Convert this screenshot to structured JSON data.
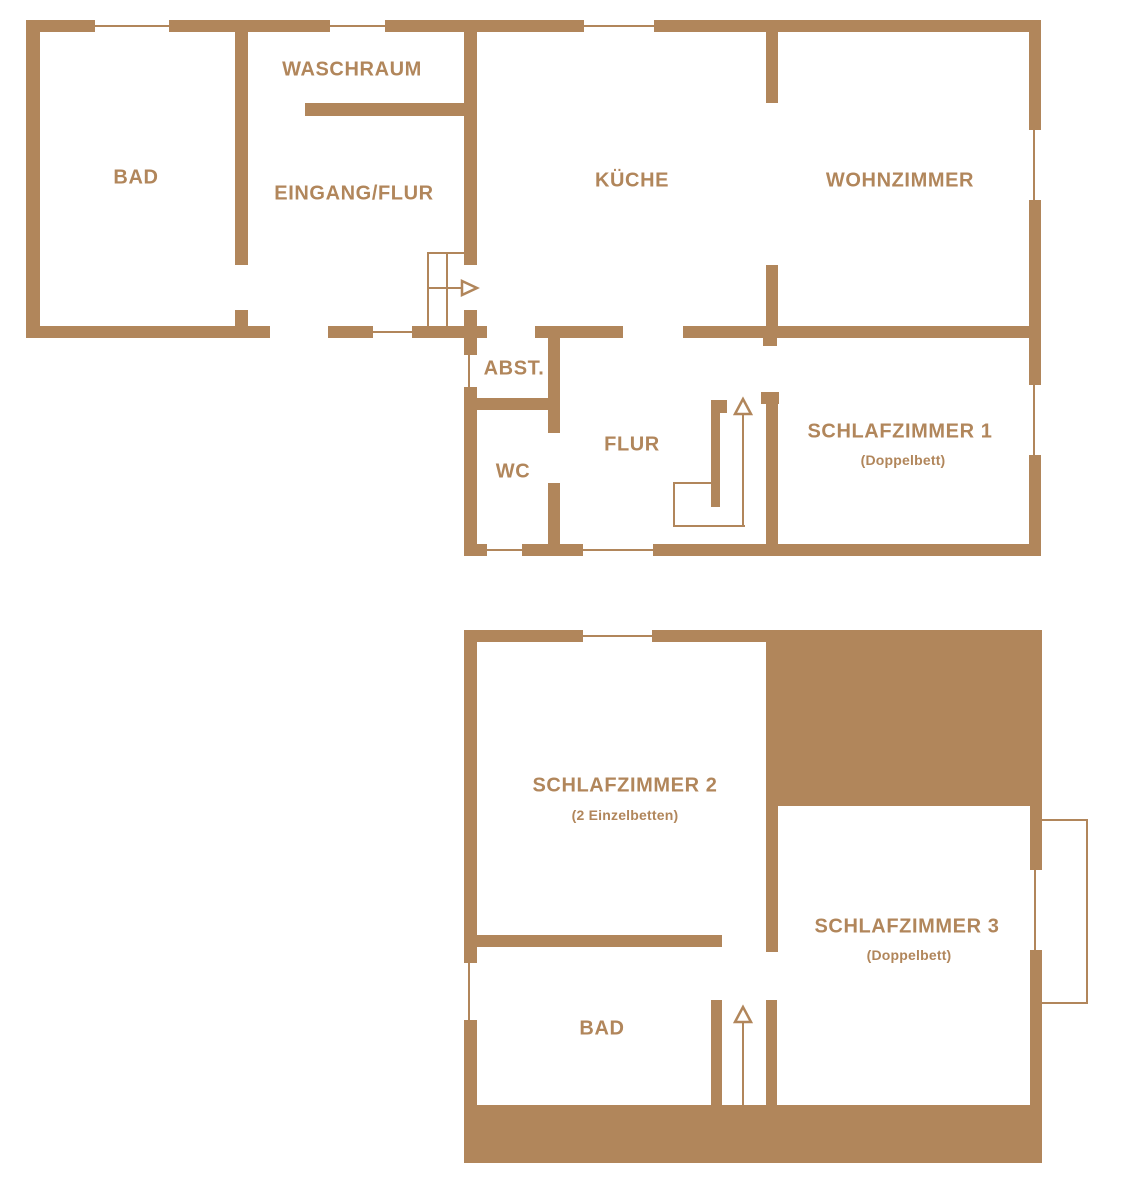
{
  "palette": {
    "wall_color": "#B1865B",
    "label_color": "#B1865B",
    "background": "#FFFFFF"
  },
  "floors": {
    "ground": {
      "rooms": {
        "bad": {
          "label": "BAD"
        },
        "waschraum": {
          "label": "WASCHRAUM"
        },
        "eingang_flur": {
          "label": "EINGANG/FLUR"
        },
        "kueche": {
          "label": "KÜCHE"
        },
        "wohnzimmer": {
          "label": "WOHNZIMMER"
        },
        "abst": {
          "label": "ABST."
        },
        "wc": {
          "label": "WC"
        },
        "flur": {
          "label": "FLUR"
        },
        "schlafzimmer1": {
          "label": "SCHLAFZIMMER 1",
          "sublabel": "(Doppelbett)"
        }
      }
    },
    "upper": {
      "rooms": {
        "schlafzimmer2": {
          "label": "SCHLAFZIMMER 2",
          "sublabel": "(2 Einzelbetten)"
        },
        "schlafzimmer3": {
          "label": "SCHLAFZIMMER 3",
          "sublabel": "(Doppelbett)"
        },
        "bad": {
          "label": "BAD"
        }
      }
    }
  }
}
